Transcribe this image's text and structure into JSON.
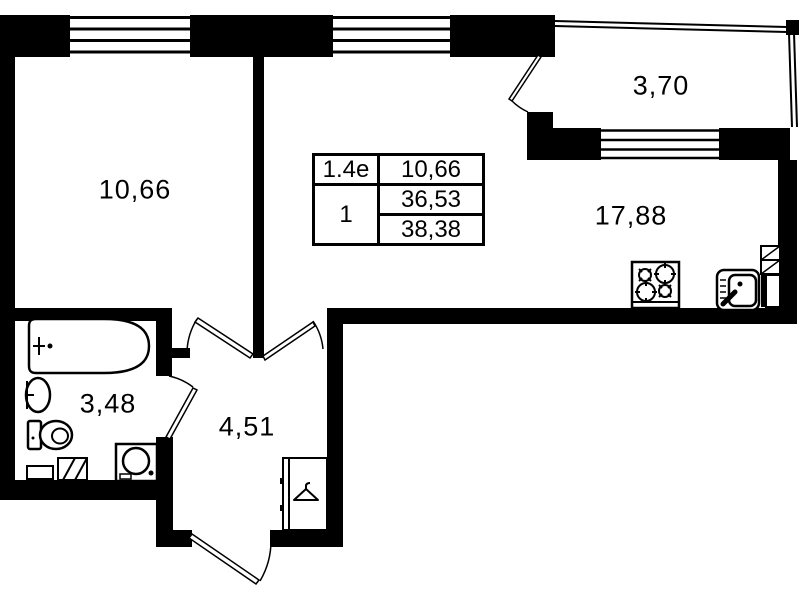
{
  "plan": {
    "title": "apartment-floor-plan",
    "rooms": [
      {
        "name": "living-room",
        "area": "10,66"
      },
      {
        "name": "balcony",
        "area": "3,70"
      },
      {
        "name": "kitchen-living-area",
        "area": "17,88"
      },
      {
        "name": "bathroom",
        "area": "3,48"
      },
      {
        "name": "hallway",
        "area": "4,51"
      }
    ],
    "info_table": {
      "unit_label": "1.4е",
      "room_count": "1",
      "living_area": "10,66",
      "area_without_balcony": "36,53",
      "total_area": "38,38"
    },
    "fixtures": [
      "bathtub",
      "washbasin",
      "toilet",
      "washing-machine",
      "stove",
      "kitchen-sink",
      "wardrobe-with-hanger",
      "ventilation-shaft"
    ],
    "colors": {
      "wall": "#000000",
      "background": "#ffffff",
      "line": "#000000"
    }
  }
}
